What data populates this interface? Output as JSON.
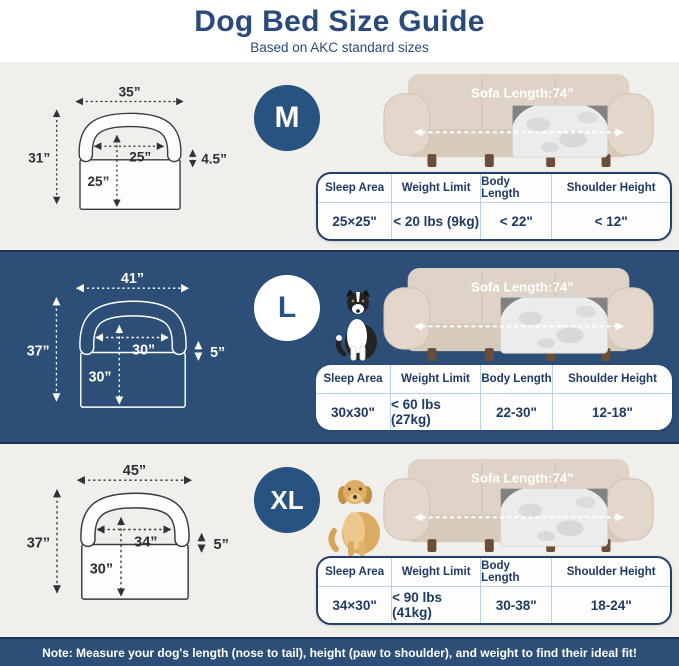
{
  "header": {
    "title": "Dog Bed Size Guide",
    "subtitle": "Based on AKC standard sizes"
  },
  "sofa": {
    "label": "Sofa Length:74”"
  },
  "table_headers": [
    "Sleep Area",
    "Weight Limit",
    "Body Length",
    "Shoulder Height"
  ],
  "sections": [
    {
      "size": "M",
      "dog": "white-pomeranian",
      "diagram": {
        "overall_width": "35”",
        "overall_height": "31”",
        "sleep_width": "25”",
        "sleep_depth": "25”",
        "bolster_height": "4.5”"
      },
      "table": {
        "sleep_area": "25×25\"",
        "weight_limit": "< 20 lbs (9kg)",
        "body_length": "< 22\"",
        "shoulder_height": "< 12\""
      }
    },
    {
      "size": "L",
      "dog": "border-collie",
      "diagram": {
        "overall_width": "41”",
        "overall_height": "37”",
        "sleep_width": "30”",
        "sleep_depth": "30”",
        "bolster_height": "5”"
      },
      "table": {
        "sleep_area": "30x30\"",
        "weight_limit": "< 60 lbs (27kg)",
        "body_length": "22-30\"",
        "shoulder_height": "12-18\""
      }
    },
    {
      "size": "XL",
      "dog": "golden-retriever",
      "diagram": {
        "overall_width": "45”",
        "overall_height": "37”",
        "sleep_width": "34”",
        "sleep_depth": "30”",
        "bolster_height": "5”"
      },
      "table": {
        "sleep_area": "34×30\"",
        "weight_limit": "< 90 lbs (41kg)",
        "body_length": "30-38\"",
        "shoulder_height": "18-24\""
      }
    }
  ],
  "note": "Note: Measure your dog's length (nose to tail), height (paw to shoulder), and weight to find their ideal fit!",
  "colors": {
    "navy_band": "#2d4f77",
    "navy_badge": "#28527f",
    "navy_text": "#1f3a63",
    "dark_separator": "#1d3454",
    "light_band": "#f0efec",
    "table_divider": "#b7d2e6",
    "sofa_beige": "#ded3c6"
  }
}
